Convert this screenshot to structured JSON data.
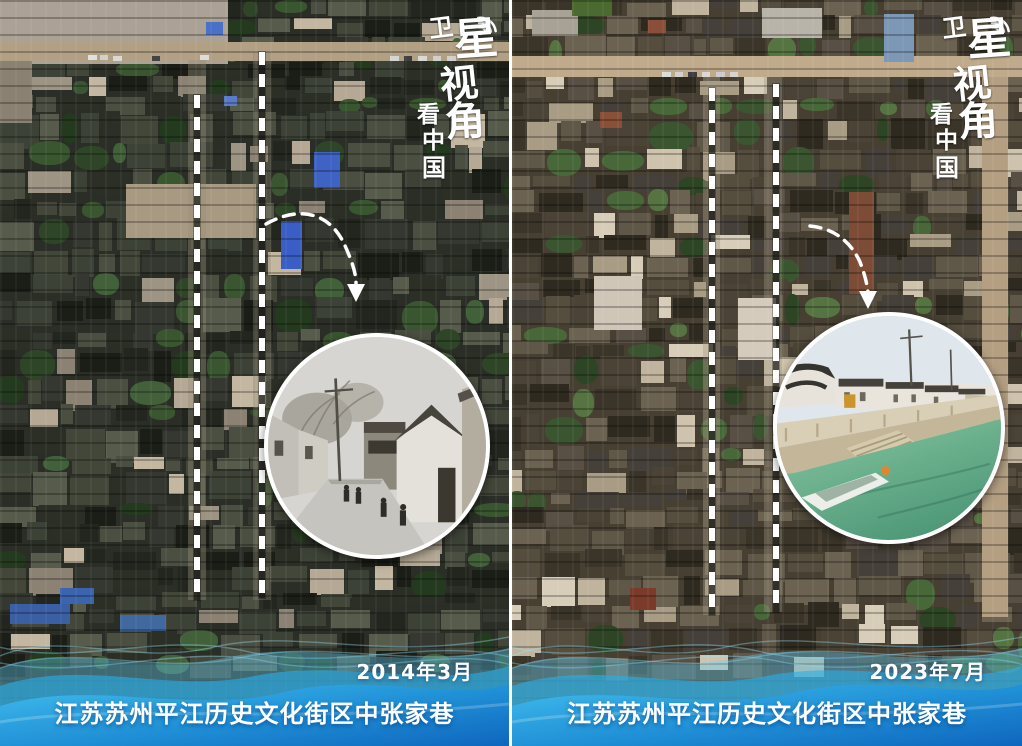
{
  "page": {
    "width": 1022,
    "height": 746,
    "divider_color": "#ffffff",
    "kind": "satellite-before-after-comparison"
  },
  "brand": {
    "name": "卫星视角看中国",
    "main_chars": [
      "卫",
      "星",
      "视",
      "角"
    ],
    "sub_chars": [
      "看",
      "中",
      "国"
    ],
    "signal_icon": "signal-arcs-icon",
    "text_color": "#ffffff"
  },
  "panels": [
    {
      "id": "before",
      "date": "2014年3月",
      "caption": "江苏苏州平江历史文化街区中张家巷",
      "inset": "bw-street-photo"
    },
    {
      "id": "after",
      "date": "2023年7月",
      "caption": "江苏苏州平江历史文化街区中张家巷",
      "inset": "canal-color-photo"
    }
  ],
  "annotation": {
    "dash_color": "#ffffff",
    "arrow_color": "#ffffff"
  },
  "footer": {
    "wave_light": "#60cdf2",
    "wave_mid": "#2cace7",
    "wave_deep": "#0f66bd",
    "text_color": "#ffffff"
  },
  "mosaic": {
    "left": {
      "seed": 20140301,
      "tree_p": 0.15,
      "light_p": 0.06,
      "roofs": [
        "#2b2f26",
        "#343830",
        "#22261e",
        "#3d4237",
        "#4a4f41",
        "#565b4b",
        "#1b1e17",
        "#43473a"
      ],
      "trees": [
        "#2f4527",
        "#3a5630",
        "#243a1e",
        "#42603a"
      ],
      "lights": [
        "#9e9484",
        "#b5a995",
        "#8b8274",
        "#c3b7a1"
      ],
      "zones": [
        {
          "x0": 228,
          "x1": 514,
          "y0": 0,
          "y1": 42
        },
        {
          "x0": 0,
          "x1": 514,
          "y0": 62,
          "y1": 662
        }
      ],
      "features": [
        {
          "n": "rubble-area",
          "x": 0,
          "y": 0,
          "w": 228,
          "h": 64,
          "c": "#aca195"
        },
        {
          "n": "road",
          "x": 0,
          "y": 42,
          "w": 509,
          "h": 19,
          "c": "#b2a084"
        },
        {
          "n": "dirt",
          "x": 0,
          "y": 61,
          "w": 32,
          "h": 62,
          "c": "#8a8172"
        },
        {
          "n": "plaza",
          "x": 126,
          "y": 184,
          "w": 130,
          "h": 54,
          "c": "#a89a82"
        },
        {
          "n": "street",
          "x": 188,
          "y": 60,
          "w": 18,
          "h": 540,
          "c": "rgba(150,142,122,0.40)"
        },
        {
          "n": "street",
          "x": 253,
          "y": 52,
          "w": 18,
          "h": 548,
          "c": "rgba(140,134,116,0.36)"
        },
        {
          "n": "car",
          "x": 88,
          "y": 55,
          "w": 9,
          "h": 5,
          "c": "#e0e0dc"
        },
        {
          "n": "car",
          "x": 100,
          "y": 55,
          "w": 8,
          "h": 5,
          "c": "#cfcfcb"
        },
        {
          "n": "car",
          "x": 113,
          "y": 56,
          "w": 9,
          "h": 5,
          "c": "#d8d8d4"
        },
        {
          "n": "car",
          "x": 152,
          "y": 56,
          "w": 8,
          "h": 5,
          "c": "#444444"
        },
        {
          "n": "car",
          "x": 200,
          "y": 55,
          "w": 9,
          "h": 5,
          "c": "#dcdcd8"
        },
        {
          "n": "car",
          "x": 390,
          "y": 56,
          "w": 9,
          "h": 5,
          "c": "#d4d4d0"
        },
        {
          "n": "car",
          "x": 404,
          "y": 56,
          "w": 8,
          "h": 5,
          "c": "#3f3f3f"
        },
        {
          "n": "car",
          "x": 418,
          "y": 56,
          "w": 9,
          "h": 5,
          "c": "#d8d8d4"
        },
        {
          "n": "car",
          "x": 433,
          "y": 56,
          "w": 8,
          "h": 5,
          "c": "#cfcfcb"
        },
        {
          "n": "car",
          "x": 447,
          "y": 56,
          "w": 9,
          "h": 5,
          "c": "#d0d0cc"
        },
        {
          "n": "blue-roof",
          "x": 314,
          "y": 152,
          "w": 26,
          "h": 36,
          "c": "#3e63c4"
        },
        {
          "n": "blue-roof",
          "x": 281,
          "y": 221,
          "w": 21,
          "h": 48,
          "c": "#3a5ec6"
        },
        {
          "n": "blue-tarp",
          "x": 206,
          "y": 22,
          "w": 17,
          "h": 13,
          "c": "#4a70c8"
        },
        {
          "n": "blue-tarp",
          "x": 224,
          "y": 96,
          "w": 13,
          "h": 10,
          "c": "#5a7cc8"
        },
        {
          "n": "blue-tarp",
          "x": 60,
          "y": 588,
          "w": 34,
          "h": 16,
          "c": "#3c64ae"
        },
        {
          "n": "blue-tarp",
          "x": 10,
          "y": 604,
          "w": 60,
          "h": 20,
          "c": "#3a5fa5"
        },
        {
          "n": "blue-tarp",
          "x": 120,
          "y": 615,
          "w": 46,
          "h": 16,
          "c": "#41699f"
        }
      ]
    },
    "right": {
      "seed": 20230701,
      "tree_p": 0.13,
      "light_p": 0.1,
      "roofs": [
        "#4a4336",
        "#554d3e",
        "#3b3529",
        "#5f5747",
        "#6b6251",
        "#2f2a20",
        "#46403a",
        "#584f45"
      ],
      "trees": [
        "#3b5530",
        "#49683a",
        "#2e4525",
        "#557442"
      ],
      "lights": [
        "#c0b49e",
        "#cfc3ad",
        "#a99c85",
        "#d8cdb9"
      ],
      "zones": [
        {
          "x0": 0,
          "x1": 514,
          "y0": 0,
          "y1": 56
        },
        {
          "x0": 0,
          "x1": 514,
          "y0": 78,
          "y1": 662
        }
      ],
      "features": [
        {
          "n": "road",
          "x": 0,
          "y": 56,
          "w": 510,
          "h": 21,
          "c": "#c0aa8c"
        },
        {
          "n": "street",
          "x": 191,
          "y": 77,
          "w": 17,
          "h": 538,
          "c": "rgba(170,158,134,0.42)"
        },
        {
          "n": "street",
          "x": 252,
          "y": 77,
          "w": 18,
          "h": 535,
          "c": "rgba(160,150,128,0.38)"
        },
        {
          "n": "side-road",
          "x": 470,
          "y": 77,
          "w": 26,
          "h": 540,
          "c": "#b49f82"
        },
        {
          "n": "light-roof",
          "x": 250,
          "y": 8,
          "w": 60,
          "h": 30,
          "c": "#b9b4aa"
        },
        {
          "n": "light-roof",
          "x": 20,
          "y": 10,
          "w": 46,
          "h": 26,
          "c": "#a8a296"
        },
        {
          "n": "green-field",
          "x": 60,
          "y": 0,
          "w": 40,
          "h": 16,
          "c": "#4a6a30"
        },
        {
          "n": "metal-roof",
          "x": 372,
          "y": 14,
          "w": 30,
          "h": 48,
          "c": "#7d98b6"
        },
        {
          "n": "red-roof",
          "x": 337,
          "y": 192,
          "w": 25,
          "h": 102,
          "c": "#7c4c36"
        },
        {
          "n": "red-roof",
          "x": 88,
          "y": 112,
          "w": 22,
          "h": 16,
          "c": "#8a5037"
        },
        {
          "n": "red-roof",
          "x": 136,
          "y": 20,
          "w": 18,
          "h": 13,
          "c": "#8a4f38"
        },
        {
          "n": "red-roof",
          "x": 118,
          "y": 588,
          "w": 26,
          "h": 22,
          "c": "#7b3b2a"
        },
        {
          "n": "white-court",
          "x": 82,
          "y": 276,
          "w": 48,
          "h": 54,
          "c": "#cfc6b8"
        },
        {
          "n": "white-court",
          "x": 226,
          "y": 298,
          "w": 38,
          "h": 62,
          "c": "#d4cbbc"
        },
        {
          "n": "car",
          "x": 150,
          "y": 72,
          "w": 9,
          "h": 5,
          "c": "#dcdcd8"
        },
        {
          "n": "car",
          "x": 163,
          "y": 72,
          "w": 8,
          "h": 5,
          "c": "#d0d0cc"
        },
        {
          "n": "car",
          "x": 176,
          "y": 72,
          "w": 9,
          "h": 5,
          "c": "#3e3e3e"
        },
        {
          "n": "car",
          "x": 190,
          "y": 72,
          "w": 8,
          "h": 5,
          "c": "#d8d8d4"
        },
        {
          "n": "car",
          "x": 204,
          "y": 72,
          "w": 9,
          "h": 5,
          "c": "#cccccc"
        },
        {
          "n": "car",
          "x": 218,
          "y": 72,
          "w": 8,
          "h": 5,
          "c": "#d4d4d0"
        }
      ]
    }
  }
}
